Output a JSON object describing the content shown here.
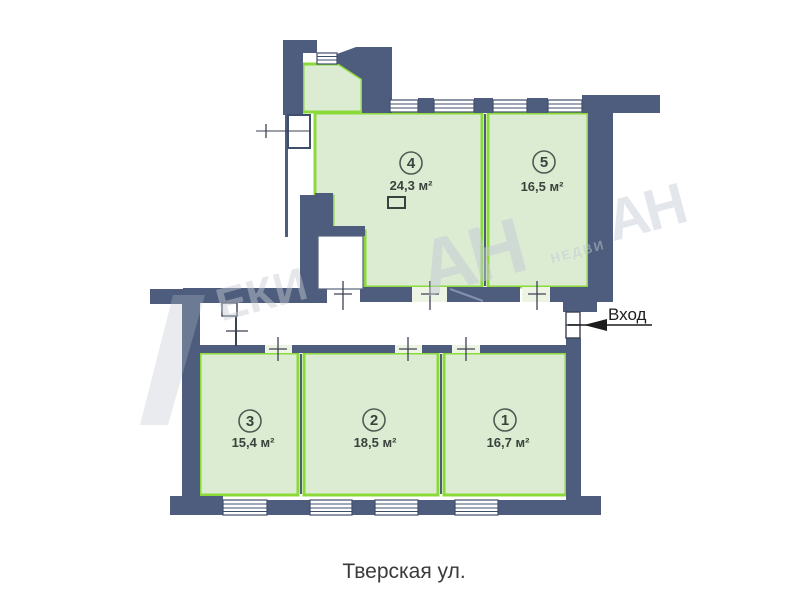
{
  "plan": {
    "street_label": "Тверская ул.",
    "entrance_label": "Вход",
    "rooms": [
      {
        "number": "1",
        "area": "16,7 м²"
      },
      {
        "number": "2",
        "area": "18,5 м²"
      },
      {
        "number": "3",
        "area": "15,4 м²"
      },
      {
        "number": "4",
        "area": "24,3 м²"
      },
      {
        "number": "5",
        "area": "16,5 м²"
      }
    ],
    "watermark": {
      "logo": "АН",
      "subtext": "НЕДВИ",
      "fragment": "ЕКИ"
    },
    "colors": {
      "wall": "#4e5d7d",
      "room_fill": "#dcecd3",
      "room_border": "#8cd93a",
      "label_text": "#39423c",
      "street_text": "#3a3a3a"
    }
  }
}
